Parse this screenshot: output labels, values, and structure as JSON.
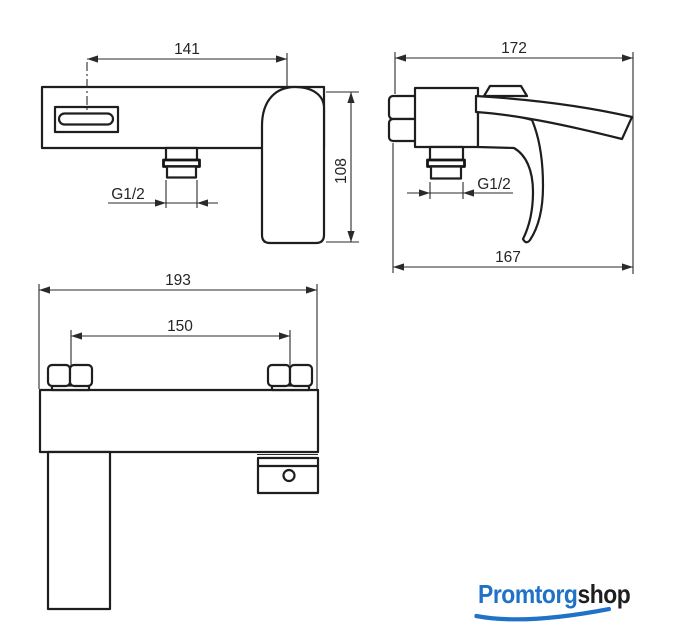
{
  "drawing": {
    "type": "technical-dimension-drawing",
    "subject": "bath-shower-mixer-faucet",
    "background_color": "#ffffff",
    "line_color": "#1e1e1e",
    "dimension_line_color": "#2a2a2a"
  },
  "dims": {
    "front_width": "141",
    "front_height": "108",
    "front_thread": "G1/2",
    "side_width_top": "172",
    "side_width_bottom": "167",
    "side_thread": "G1/2",
    "bottom_width": "193",
    "bottom_mount_spacing": "150"
  },
  "logo": {
    "primary": "Promtorg",
    "secondary": "shop",
    "primary_color": "#2071c8",
    "secondary_color": "#1e1e1e"
  }
}
